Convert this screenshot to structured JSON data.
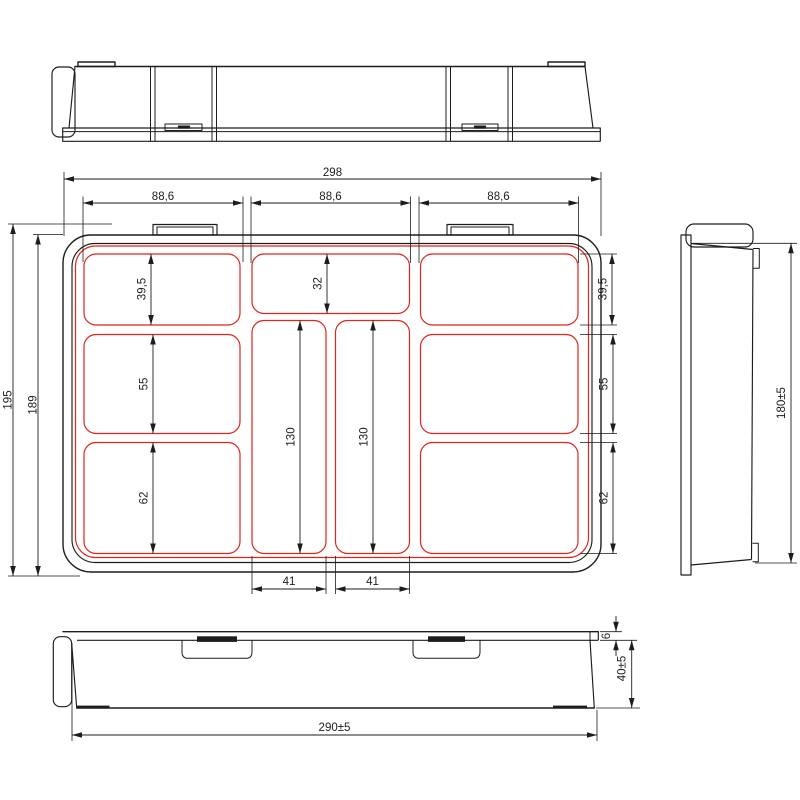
{
  "drawing": {
    "type": "technical-drawing",
    "subject": "compartment tray / organizer box, four orthographic views",
    "colors": {
      "line": "#1d1d1b",
      "compartment": "#e0251d",
      "background": "#ffffff"
    },
    "dimensions": {
      "plan": {
        "overall_width": "298",
        "section_widths": [
          "88,6",
          "88,6",
          "88,6"
        ],
        "total_height": "195",
        "inner_height": "189",
        "left_rows": [
          "39,5",
          "55",
          "62"
        ],
        "right_rows": [
          "39,5",
          "55",
          "62"
        ],
        "center_top_height": "32",
        "channel_heights": [
          "130",
          "130"
        ],
        "channel_widths": [
          "41",
          "41"
        ]
      },
      "side_view": {
        "height": "180±5"
      },
      "bottom_view": {
        "width": "290±5",
        "lid_thickness": "6",
        "body_depth": "40±5"
      }
    }
  }
}
